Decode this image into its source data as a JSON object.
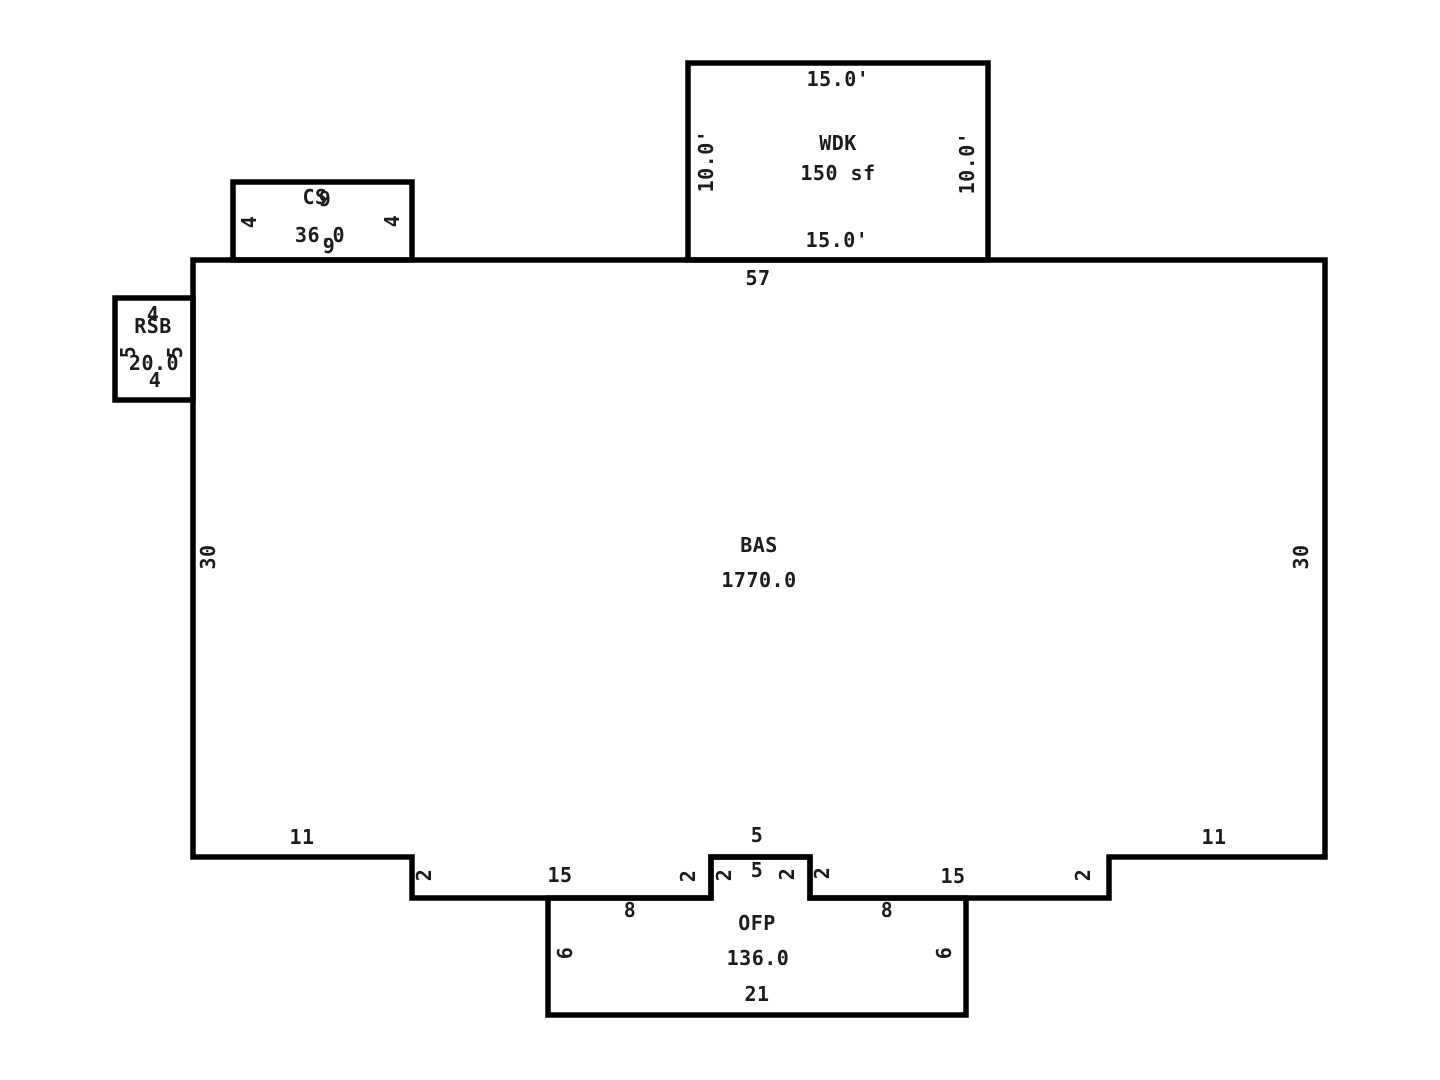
{
  "canvas": {
    "background": "#ffffff",
    "line_color": "#000000",
    "text_color": "#1c1c1c"
  },
  "areas": {
    "wdk": {
      "label": "WDK",
      "area": "150 sf",
      "dim_top": "15.0'",
      "dim_bottom": "15.0'",
      "dim_left": "10.0'",
      "dim_right": "10.0'"
    },
    "cs": {
      "label": "CS",
      "area": "36.0",
      "dim_top": "9",
      "dim_bottom": "9",
      "dim_left": "4",
      "dim_right": "4"
    },
    "rsb": {
      "label": "RSB",
      "area": "20.0",
      "dim_top": "4",
      "dim_bottom": "4",
      "dim_left": "5",
      "dim_right": "5"
    },
    "bas": {
      "label": "BAS",
      "area": "1770.0",
      "dim_top": "57",
      "dim_left": "30",
      "dim_right": "30",
      "dim_bottom_left": "11",
      "dim_bottom_right": "11",
      "dim_step_left": "2",
      "dim_step_right": "2",
      "dim_shelf_left": "15",
      "dim_shelf_right": "15",
      "dim_bump_top": "5",
      "dim_bump_side_left": "2",
      "dim_bump_side_right": "2"
    },
    "ofp": {
      "label": "OFP",
      "area": "136.0",
      "dim_bottom": "21",
      "dim_left": "6",
      "dim_right": "6",
      "dim_top_left": "8",
      "dim_top_right": "8",
      "dim_bump_inner": "5",
      "dim_bump_inner_left": "2",
      "dim_bump_inner_right": "2"
    }
  }
}
